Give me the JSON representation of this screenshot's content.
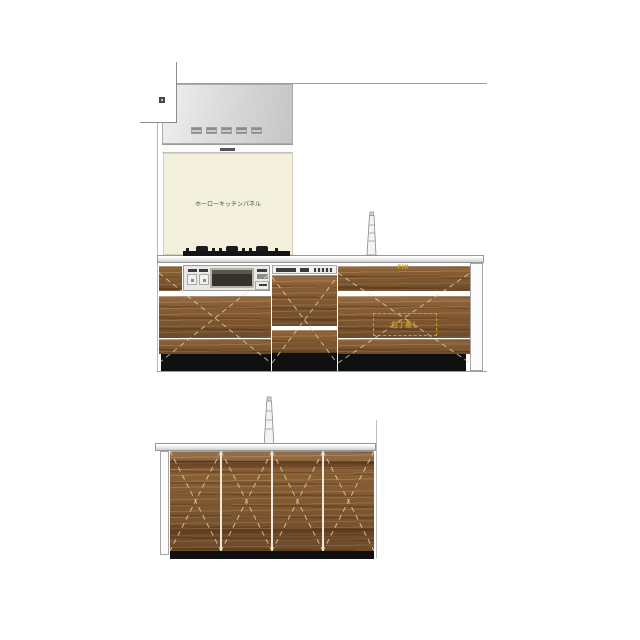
{
  "annotations": {
    "kitchen_panel_label": "ホーローキッチンパネル",
    "fix_label": "FIX",
    "knife_holder_label": "包丁差し"
  },
  "colors": {
    "annotation_yellow": "#c2a02a",
    "wood_brown": "#8a5f35",
    "toe_kick_black": "#101010",
    "counter_gray": "#d9d9d9",
    "hood_gray": "#d4d4d4",
    "panel_cream": "#f3f0de"
  },
  "icons": [
    "range-hood-icon",
    "hood-vent-icon",
    "wall-switch-icon",
    "gas-cooktop-icon",
    "faucet-icon",
    "built-in-oven-icon",
    "dishwasher-icon"
  ]
}
